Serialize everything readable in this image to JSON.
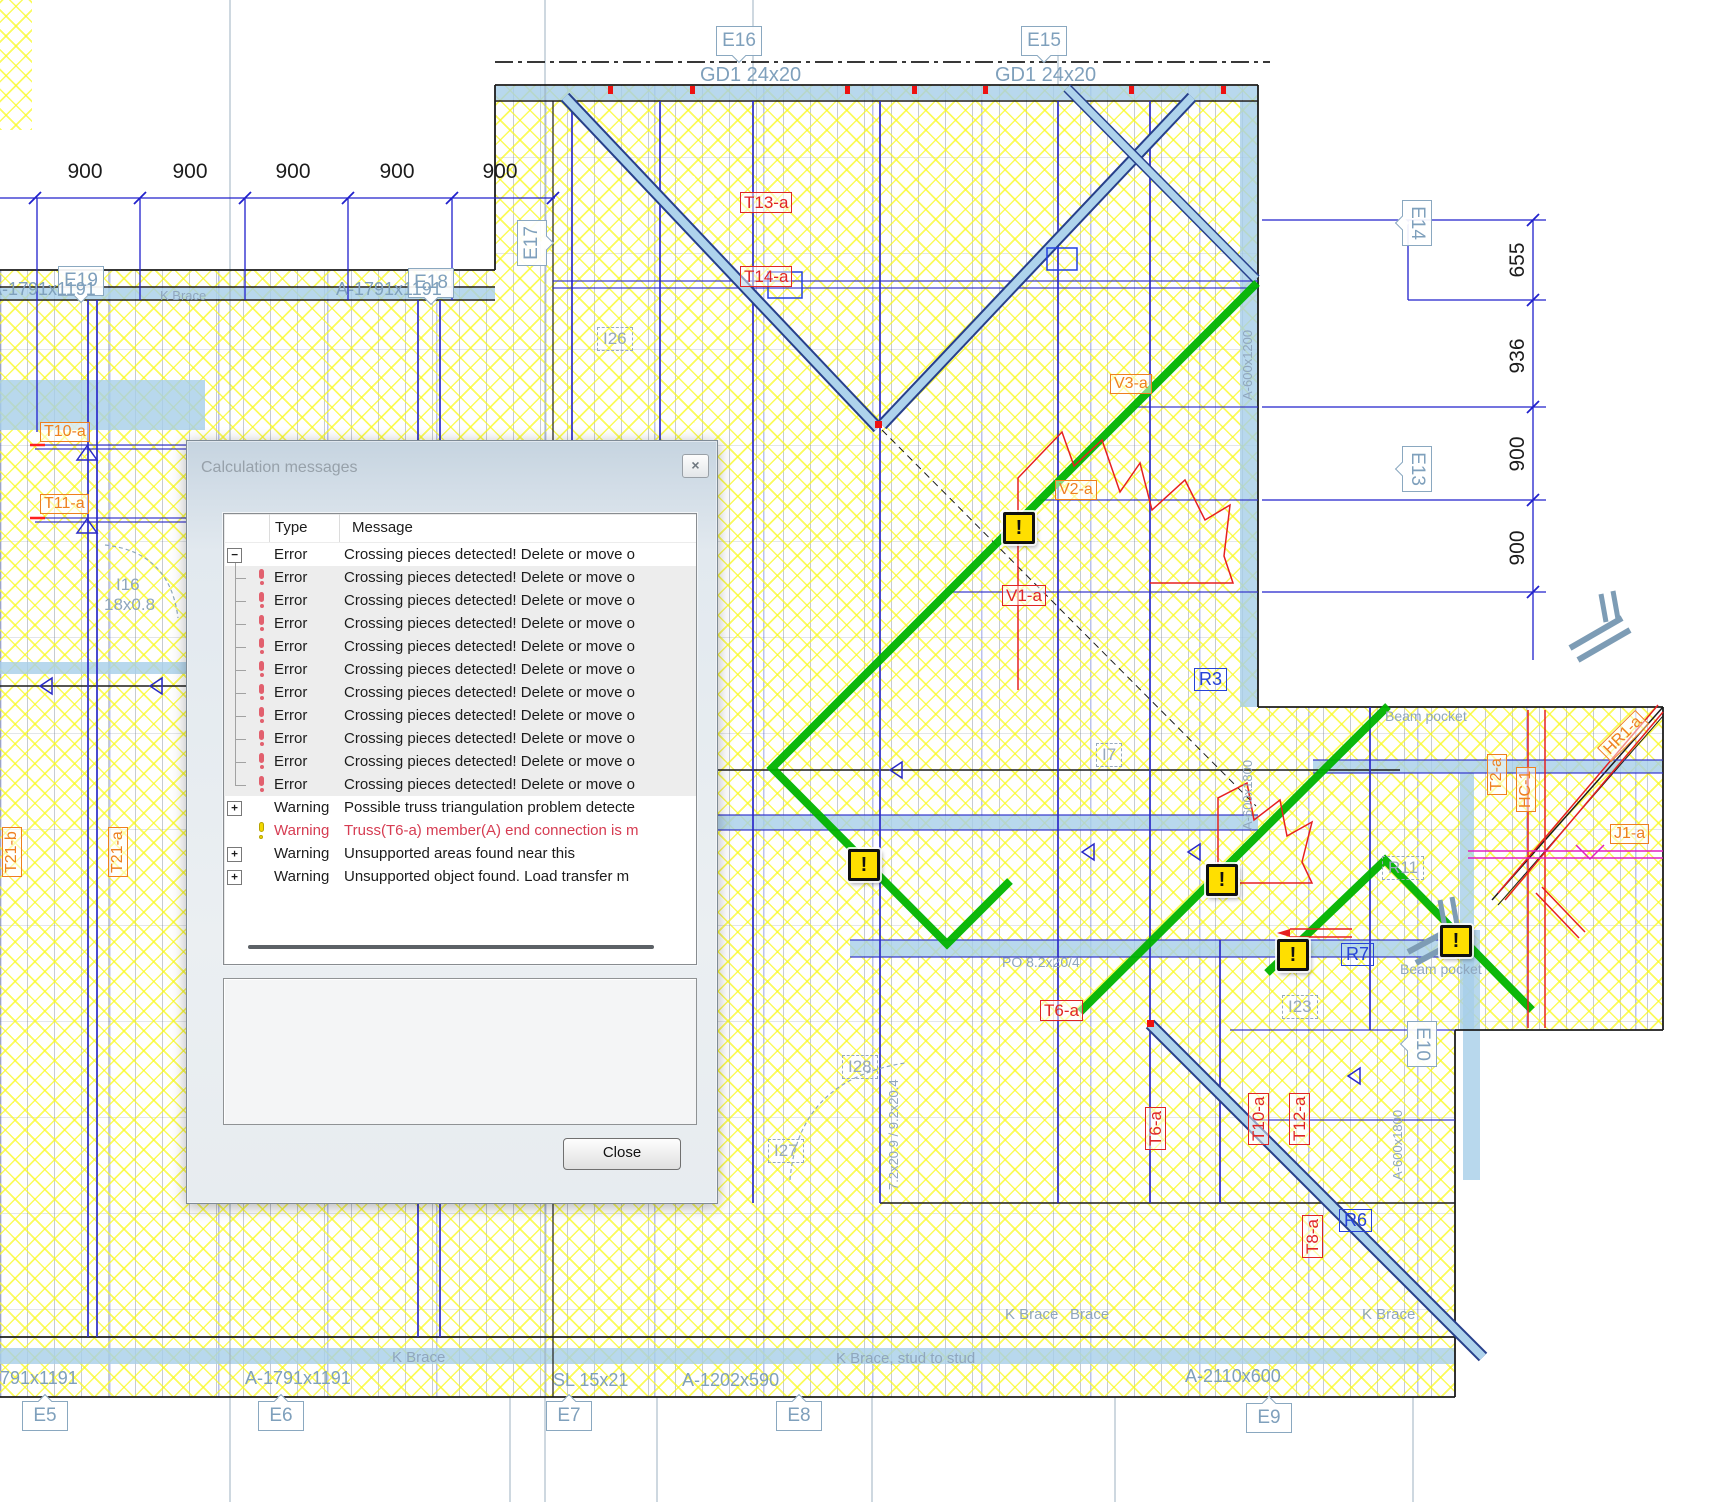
{
  "dialog": {
    "title": "Calculation messages",
    "close_icon": "×",
    "columns": {
      "type": "Type",
      "message": "Message"
    },
    "rows": [
      {
        "expander": "minus",
        "icon": null,
        "child": false,
        "last": false,
        "shaded": false,
        "red": false,
        "type": "Error",
        "message": "Crossing pieces detected! Delete or move o"
      },
      {
        "expander": null,
        "icon": "red",
        "child": true,
        "last": false,
        "shaded": true,
        "red": false,
        "type": "Error",
        "message": "Crossing pieces detected! Delete or move o"
      },
      {
        "expander": null,
        "icon": "red",
        "child": true,
        "last": false,
        "shaded": true,
        "red": false,
        "type": "Error",
        "message": "Crossing pieces detected! Delete or move o"
      },
      {
        "expander": null,
        "icon": "red",
        "child": true,
        "last": false,
        "shaded": true,
        "red": false,
        "type": "Error",
        "message": "Crossing pieces detected! Delete or move o"
      },
      {
        "expander": null,
        "icon": "red",
        "child": true,
        "last": false,
        "shaded": true,
        "red": false,
        "type": "Error",
        "message": "Crossing pieces detected! Delete or move o"
      },
      {
        "expander": null,
        "icon": "red",
        "child": true,
        "last": false,
        "shaded": true,
        "red": false,
        "type": "Error",
        "message": "Crossing pieces detected! Delete or move o"
      },
      {
        "expander": null,
        "icon": "red",
        "child": true,
        "last": false,
        "shaded": true,
        "red": false,
        "type": "Error",
        "message": "Crossing pieces detected! Delete or move o"
      },
      {
        "expander": null,
        "icon": "red",
        "child": true,
        "last": false,
        "shaded": true,
        "red": false,
        "type": "Error",
        "message": "Crossing pieces detected! Delete or move o"
      },
      {
        "expander": null,
        "icon": "red",
        "child": true,
        "last": false,
        "shaded": true,
        "red": false,
        "type": "Error",
        "message": "Crossing pieces detected! Delete or move o"
      },
      {
        "expander": null,
        "icon": "red",
        "child": true,
        "last": false,
        "shaded": true,
        "red": false,
        "type": "Error",
        "message": "Crossing pieces detected! Delete or move o"
      },
      {
        "expander": null,
        "icon": "red",
        "child": true,
        "last": true,
        "shaded": true,
        "red": false,
        "type": "Error",
        "message": "Crossing pieces detected! Delete or move o"
      },
      {
        "expander": "plus",
        "icon": null,
        "child": false,
        "last": false,
        "shaded": false,
        "red": false,
        "type": "Warning",
        "message": "Possible truss triangulation problem detecte"
      },
      {
        "expander": null,
        "icon": "yellow",
        "child": false,
        "last": false,
        "shaded": false,
        "red": true,
        "type": "Warning",
        "message": "Truss(T6-a) member(A) end connection is m"
      },
      {
        "expander": "plus",
        "icon": null,
        "child": false,
        "last": false,
        "shaded": false,
        "red": false,
        "type": "Warning",
        "message": "Unsupported areas found near this"
      },
      {
        "expander": "plus",
        "icon": null,
        "child": false,
        "last": false,
        "shaded": false,
        "red": false,
        "type": "Warning",
        "message": "Unsupported object found. Load transfer m"
      }
    ],
    "close_button": "Close"
  },
  "plan": {
    "warning_glyph": "!",
    "dims_top": [
      "900",
      "900",
      "900",
      "900",
      "900"
    ],
    "dims_right": [
      "655",
      "936",
      "900",
      "900"
    ],
    "girders": {
      "gd1_left": "GD1 24x20",
      "gd1_right": "GD1 24x20"
    },
    "grid_tags": {
      "e5": "E5",
      "e6": "E6",
      "e7": "E7",
      "e8": "E8",
      "e9": "E9",
      "e10": "E10",
      "e13": "E13",
      "e14": "E14",
      "e15": "E15",
      "e16": "E16",
      "e17": "E17",
      "e18": "E18",
      "e19": "E19"
    },
    "labels": {
      "a1791_top_left": "A-1791x1191",
      "a1791_top_mid": "A-1791x1191",
      "kbrace_top": "K Brace",
      "t13a": "T13-a",
      "t14a": "T14-a",
      "t10a_left": "T10-a",
      "t11a_left": "T11-a",
      "t21b": "T21-b",
      "t21a": "T21-a",
      "t18a": "T18-a",
      "i16": "I16",
      "i16_size": "18x0.8",
      "v1a": "V1-a",
      "v2a": "V2-a",
      "v3a": "V3-a",
      "r3": "R3",
      "r7": "R7",
      "r6": "R6",
      "r11": "R11",
      "i7": "I7",
      "i23": "I23",
      "i26": "I26",
      "i27": "I27",
      "i28": "I28",
      "hr1a": "HR1-a",
      "j1a": "J1-a",
      "hc1": "HC-1",
      "t2a": "T2-a",
      "t6a_rot": "T6-a",
      "t10a_rot": "T10-a",
      "t12a_rot": "T12-a",
      "t8a_rot": "T8-a",
      "t6a_floor": "T6-a",
      "beam_pocket_top": "Beam pocket",
      "beam_pocket_bottom": "Beam pocket",
      "kbrace_wall_left": "K Brace",
      "kbrace_stud": "K Brace, stud to stud",
      "kbrace_mid_a": "K Brace",
      "brace_mid_b": "Brace",
      "kbrace_right": "K Brace",
      "a1791_bottom_left": "A-1791x1191",
      "a1791_bottom_mid": "A-1791x1191",
      "sl_15x21": "SL 15x21",
      "a1202x590": "A-1202x590",
      "a2110x600": "A-2110x600",
      "po_label": "PO 8.2x20/4",
      "p_rot_label": "7.2x20.9 / 9.2x20.4",
      "a600_1": "A-600x1200",
      "a600_2": "A-600x1800",
      "a600_3": "A-600x1800"
    }
  },
  "colors": {
    "highlight_green": "#00b400",
    "hatch_yellow": "#f9f91e",
    "beam_blue": "#a6cee8",
    "line_blue": "#2a2ac8",
    "error_red": "#e02525",
    "orange": "#ef7f1f",
    "magenta": "#e020c0",
    "warning_yellow": "#ffdf00"
  }
}
